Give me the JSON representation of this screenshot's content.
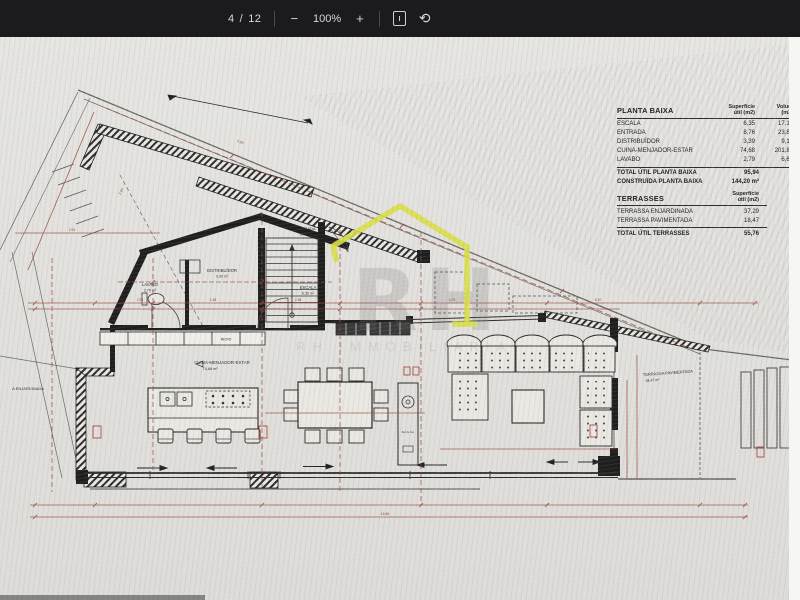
{
  "toolbar": {
    "page_current": "4",
    "page_divider": "/",
    "page_count": "12",
    "zoom_out": "−",
    "zoom_level": "100%",
    "zoom_in": "+",
    "rotate_glyph": "⟲"
  },
  "plan": {
    "labels": {
      "lavabo": {
        "name": "LAVABO",
        "area": "2,79 m²"
      },
      "distribuidor": {
        "name": "DISTRIBUÏDOR",
        "area": "3,39 m²"
      },
      "escala": {
        "name": "ESCALA",
        "area": "6,35 m²"
      },
      "entrada": {
        "name": "ENTRADA",
        "area": "8,76 m²"
      },
      "cuina": {
        "name": "CUINA-MENJADOR-ESTAR",
        "area": "74,68 m²"
      },
      "terrassa_pav": {
        "name": "TERRASSA PAVIMENTADA",
        "area": "18,47 m²"
      },
      "terrassa_enj_partial": "A ENJARDINADA",
      "micro": "MICRO",
      "fireplace": "llar de foc"
    },
    "dim_labels": [
      "3.00",
      "5.00",
      "2.35",
      "1.38",
      "2.38",
      "4.75",
      "6.10",
      "2.93",
      "16.65"
    ],
    "colors": {
      "dimension_red": "#9a473d",
      "wall_black": "#1f1f1f",
      "watermark_yellow": "#d9df49"
    }
  },
  "watermark": {
    "letters": "RH",
    "subtext": "RH IMMOBILIÀRIA"
  },
  "area_table": {
    "title": "PLANTA BAIXA",
    "col_headers": [
      [
        "Superfície",
        "útil (m2)"
      ],
      [
        "Volum",
        "(m3)"
      ],
      [
        "Il·lum",
        "(m2)"
      ]
    ],
    "rows": [
      {
        "name": "ESCALA",
        "sup": "6,35",
        "vol": "17,15",
        "il": "5,0"
      },
      {
        "name": "ENTRADA",
        "sup": "8,76",
        "vol": "23,88",
        "il": "5,9"
      },
      {
        "name": "DISTRIBUÏDOR",
        "sup": "3,39",
        "vol": "9,15",
        "il": ""
      },
      {
        "name": "CUINA-MENJADOR-ESTAR",
        "sup": "74,68",
        "vol": "201,87",
        "il": "35,9"
      },
      {
        "name": "LAVABO",
        "sup": "2,79",
        "vol": "6,69",
        "il": ""
      }
    ],
    "total_util": {
      "label": "TOTAL ÚTIL PLANTA  BAIXA",
      "value": "95,94"
    },
    "construida": {
      "label": "CONSTRUÏDA PLANTA  BAIXA",
      "value": "144,20 m²"
    },
    "terrasses": {
      "title": "TERRASSES",
      "col_header": [
        "Superfície",
        "útil (m2)"
      ],
      "rows": [
        {
          "name": "TERRASSA ENJARDINADA",
          "sup": "37,29"
        },
        {
          "name": "TERRASSA PAVIMENTADA",
          "sup": "18,47"
        }
      ],
      "total": {
        "label": "TOTAL ÚTIL TERRASSES",
        "value": "55,76"
      }
    }
  }
}
